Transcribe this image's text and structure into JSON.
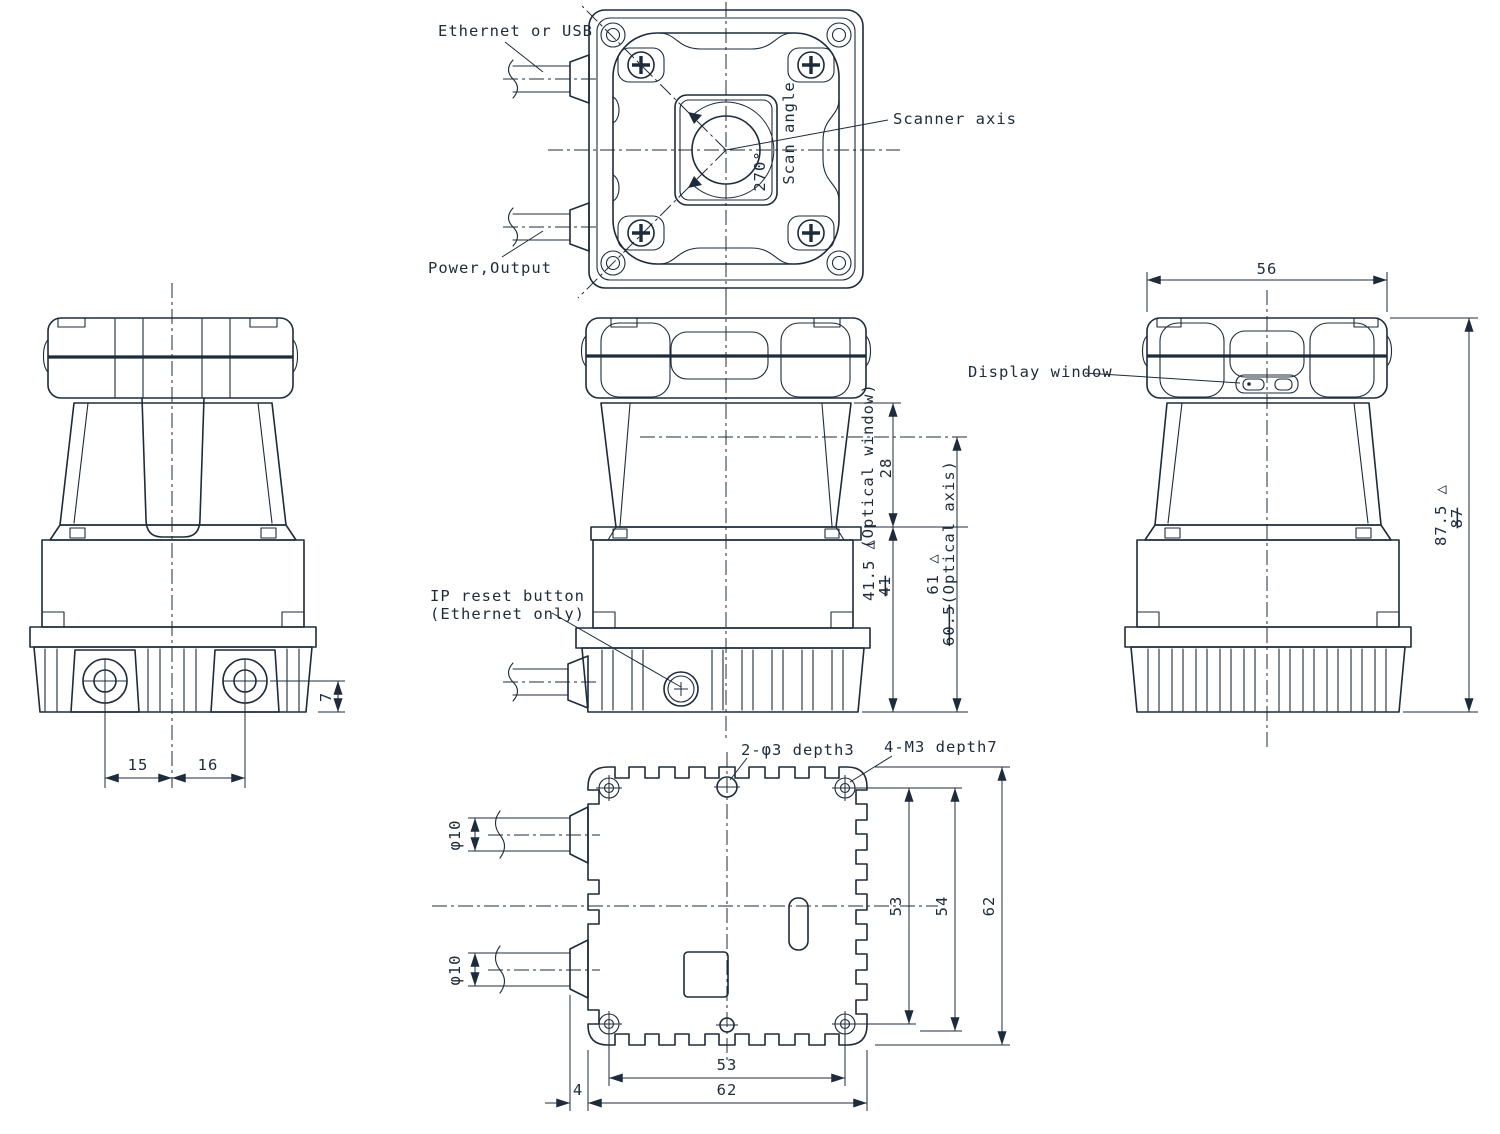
{
  "drawing": {
    "labels": {
      "ethernet_or_usb": "Ethernet or USB",
      "power_output": "Power,Output",
      "scanner_axis": "Scanner axis",
      "scan_angle": "Scan angle",
      "scan_angle_value": "270°",
      "display_window": "Display window",
      "ip_reset_line1": "IP reset button",
      "ip_reset_line2": "(Ethernet only)",
      "hole_note_center": "2-φ3 depth3",
      "hole_note_corner": "4-M3 depth7",
      "optical_window": "(Optical window)",
      "optical_axis": "(Optical axis)"
    },
    "dimensions": {
      "head_width": "56",
      "total_height": "87.5",
      "total_height_old": "87",
      "optical_window_height": "28",
      "window_to_base": "41.5",
      "window_to_base_old": "41",
      "optical_axis_height": "61",
      "optical_axis_height_old": "60.5",
      "hole_to_base_edge": "7",
      "hole_left_to_center": "15",
      "center_to_hole_right": "16",
      "cable_diameter": "φ10",
      "mount_pitch_vertical": "53",
      "body_inner_height": "54",
      "body_height": "62",
      "mount_pitch_horizontal": "53",
      "body_width": "62",
      "cable_edge_offset": "4"
    },
    "revision_mark": "△",
    "colors": {
      "line": "#1d2b3a",
      "background": "#ffffff"
    }
  }
}
